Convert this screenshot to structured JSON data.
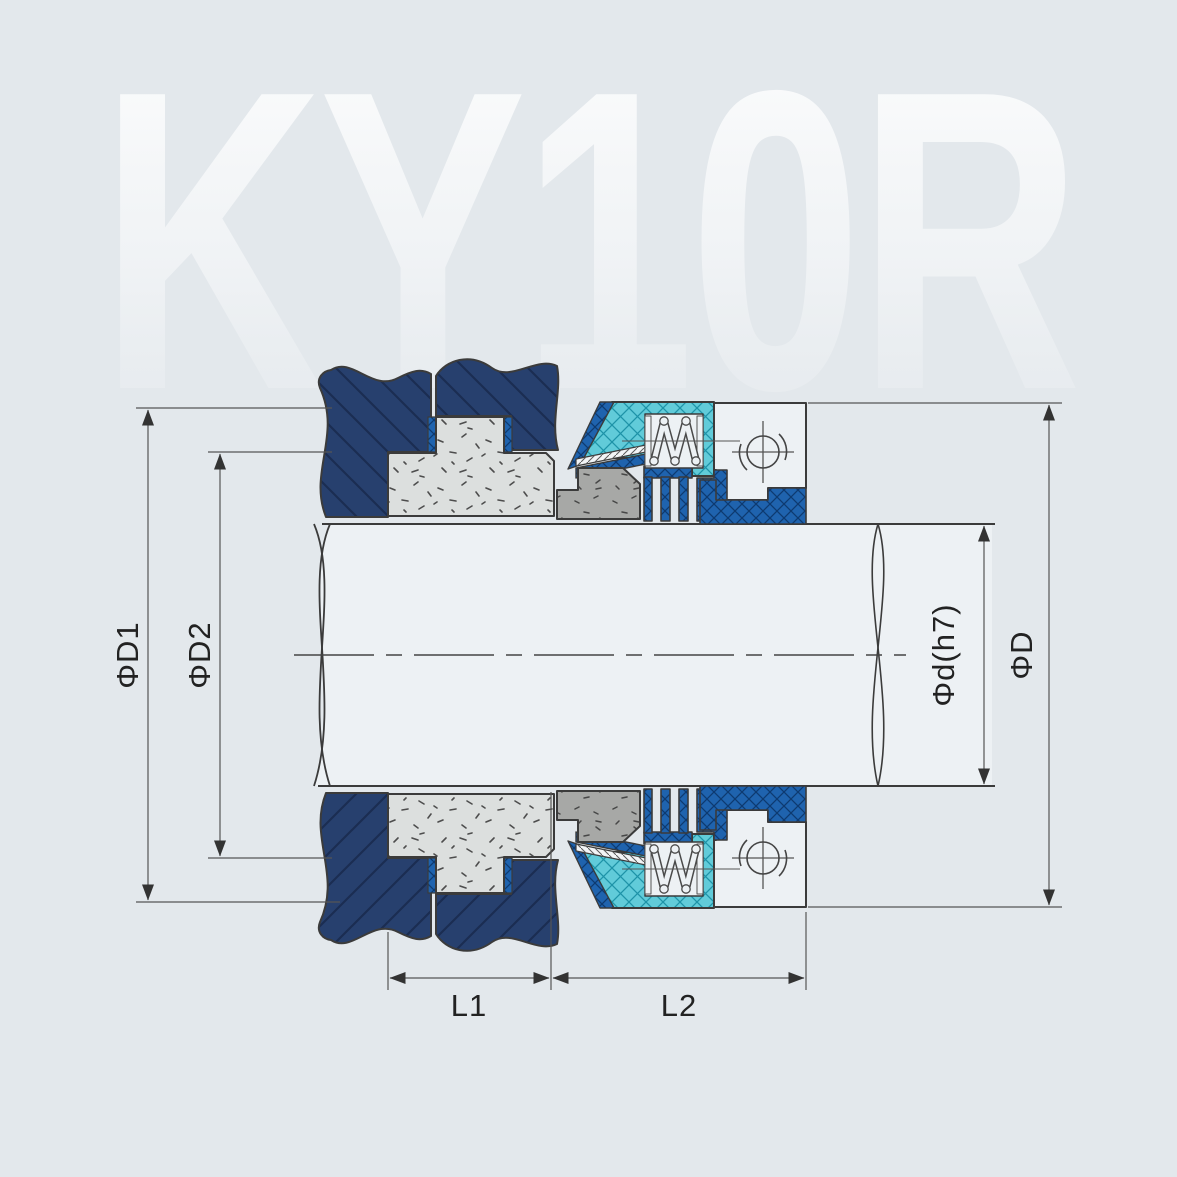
{
  "title": "KY10R mechanical seal cross-section drawing",
  "watermark": "KY10R",
  "dimensions": {
    "d1": "ΦD1",
    "d2": "ΦD2",
    "d_h7": "Φd(h7)",
    "D": "ΦD",
    "l1": "L1",
    "l2": "L2"
  },
  "colors": {
    "background": "#e3e8ec",
    "housing_navy": "#27406e",
    "metal_blue": "#1f63ae",
    "rubber_cyan": "#61cbd9",
    "seat_gray": "#dcdfde",
    "face_gray": "#a7a8a6",
    "shaft_white": "#edf1f4",
    "line": "#3b3b3b",
    "watermark": "#ffffff"
  },
  "parts": [
    {
      "name": "gland-housing",
      "fill": "navy-diagonal-hatch"
    },
    {
      "name": "stationary-seat",
      "fill": "light-gray-speckle"
    },
    {
      "name": "seat-gasket",
      "fill": "blue-crosshatch"
    },
    {
      "name": "rotating-face",
      "fill": "gray-speckle"
    },
    {
      "name": "rubber-bellows",
      "fill": "cyan-crosshatch"
    },
    {
      "name": "spring",
      "fill": "white-coil"
    },
    {
      "name": "metal-retainer",
      "fill": "blue-crosshatch"
    },
    {
      "name": "drive-collar",
      "fill": "white"
    },
    {
      "name": "set-screw",
      "fill": "circle-symbol"
    },
    {
      "name": "shaft",
      "fill": "white"
    }
  ]
}
